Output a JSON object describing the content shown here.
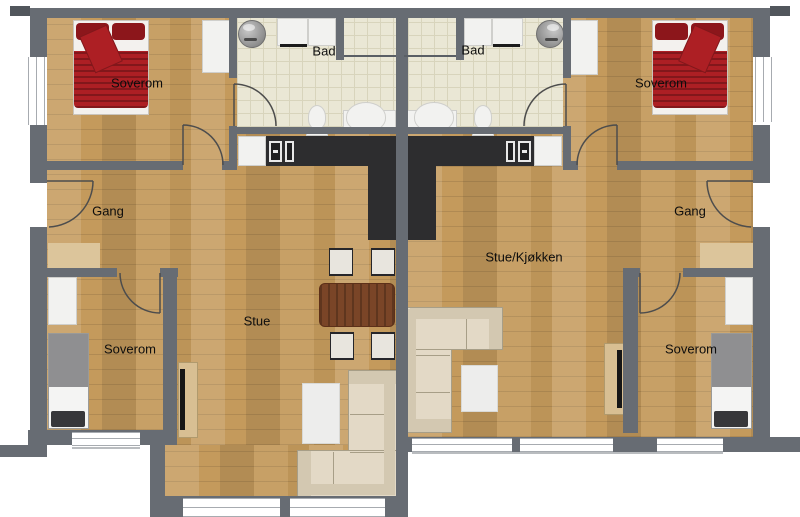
{
  "rooms": {
    "soverom_tl": "Soverom",
    "bad_left": "Bad",
    "bad_right": "Bad",
    "soverom_tr": "Soverom",
    "gang_left": "Gang",
    "gang_right": "Gang",
    "stue": "Stue",
    "stue_kjokken": "Stue/Kjøkken",
    "soverom_bl": "Soverom",
    "soverom_br": "Soverom"
  },
  "colors": {
    "wall": "#676c73",
    "wall_dark": "#51565c",
    "wood": "#c49a5c",
    "tile": "#eae7d5",
    "tile_line": "#d8d4bc",
    "counter": "#2d2d2f",
    "fixture_white": "#f2f2f0",
    "sofa": "#e3d9c6",
    "sofa_dark": "#d3c8b1",
    "sofa_line": "#a79e87",
    "table_brown": "#7a4527",
    "bed_red": "#ad1f24",
    "bed_red_dark": "#8c161b",
    "bed_gray": "#8f8f91",
    "pillow_dark": "#37373a",
    "mat": "#dcc59b",
    "bench": "#d8bf93",
    "tv_black": "#161616",
    "door_arc": "#4d4d4d",
    "window_line": "#a7abb0"
  }
}
